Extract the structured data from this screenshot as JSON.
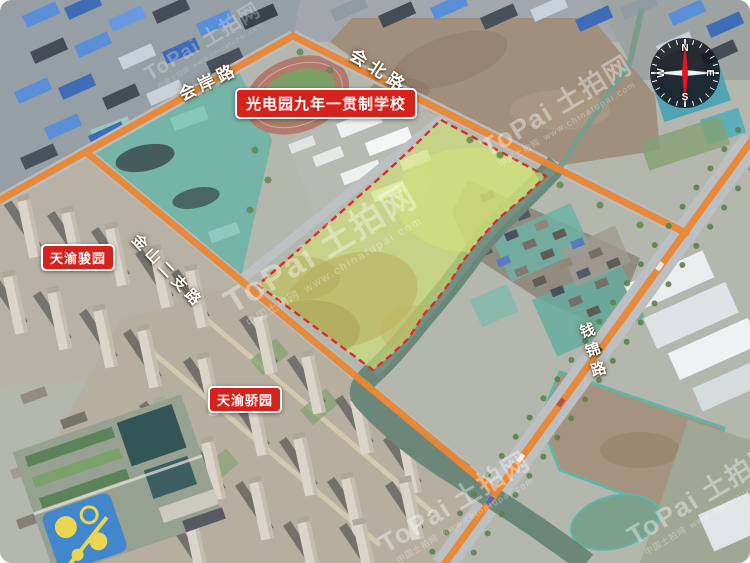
{
  "annotations": {
    "school_badge": "光电园九年一贯制学校",
    "community_badge_left": "天渝骏园",
    "community_badge_bottom": "天渝骄园"
  },
  "road_labels": {
    "top_left": "会岸路",
    "top_right": "会北路",
    "middle": "金山二支路",
    "right_vertical": "钱锦路"
  },
  "compass": {
    "north": "N",
    "south": "S",
    "west": "W",
    "east": "E"
  },
  "watermark": {
    "logo_latin": "ToPai",
    "logo_cn": "土拍网",
    "tagline": "中国土拍网",
    "url": "www.chinatupai.com"
  },
  "colors": {
    "road_highlight": "#EE7C1E",
    "parcel_boundary": "#E41C1C",
    "parcel_fill": "#CDE060",
    "badge_bg": "#D3231C",
    "badge_border": "#FFFFFF",
    "label_text": "#FFFFFF",
    "compass_needle": "#E8141E"
  }
}
